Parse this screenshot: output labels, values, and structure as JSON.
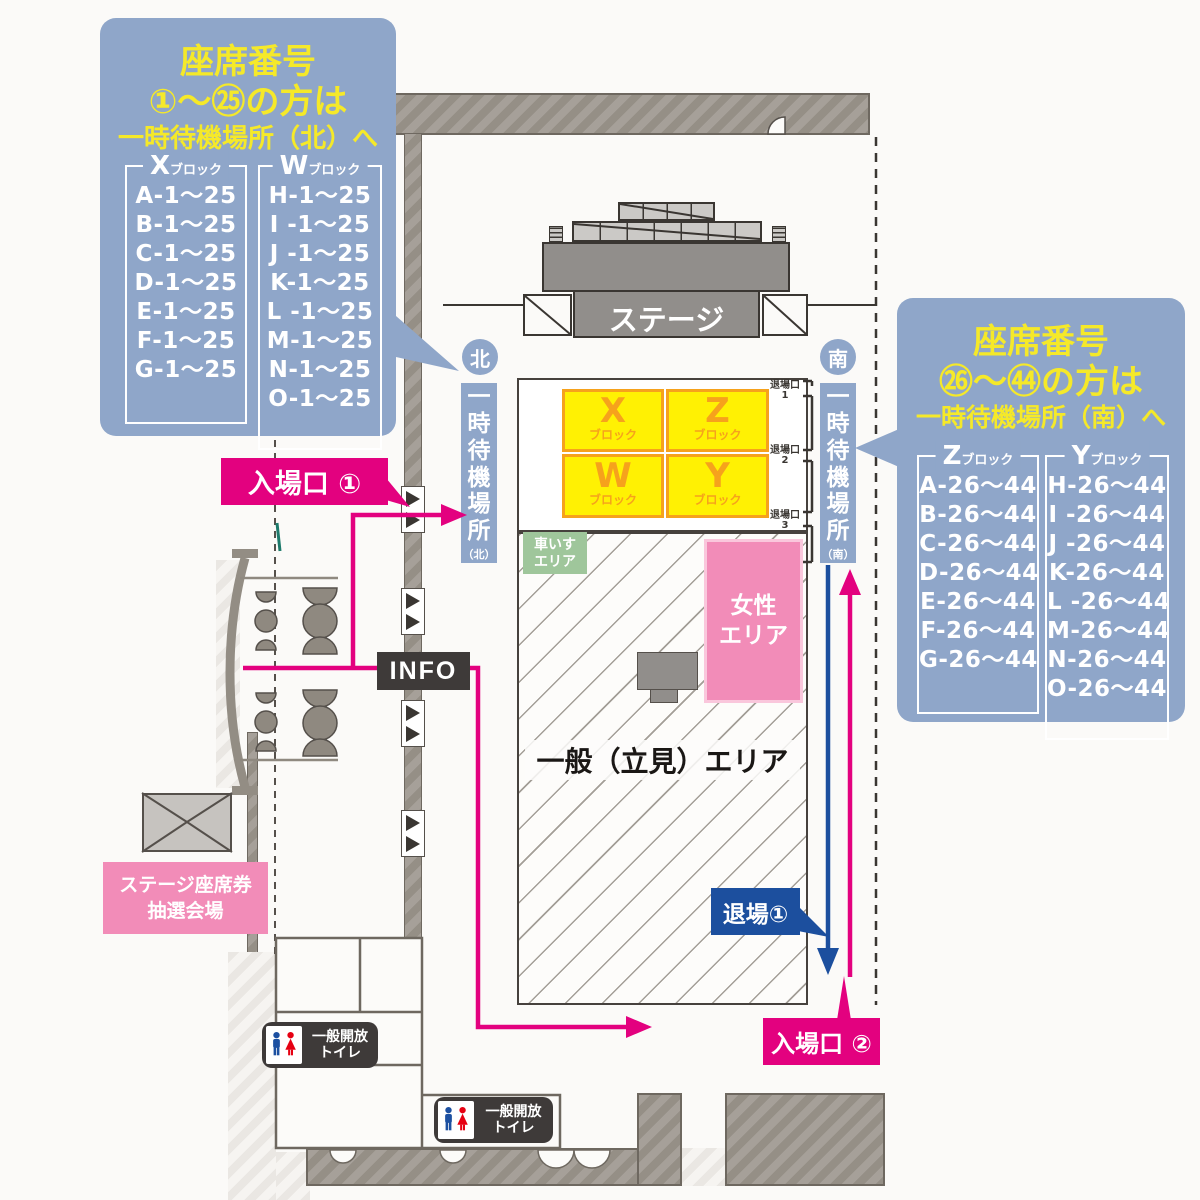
{
  "colors": {
    "panel_blue": "#8FA6C9",
    "title_yellow": "#F5E929",
    "block_yellow": "#FFF103",
    "block_orange": "#F6A21C",
    "route_pink": "#E3017F",
    "route_blue": "#1C4F9E",
    "women_pink": "#F28CB8",
    "wheelchair_green": "#9FC69B",
    "dark_gray": "#3E3A39"
  },
  "panels": {
    "north": {
      "title_line1": "座席番号",
      "title_line2": "①〜㉕の方は",
      "title_line3": "一時待機場所（北）へ",
      "columns": [
        {
          "letter": "X",
          "suffix": "ブロック",
          "rows": [
            "A-1〜25",
            "B-1〜25",
            "C-1〜25",
            "D-1〜25",
            "E-1〜25",
            "F-1〜25",
            "G-1〜25"
          ]
        },
        {
          "letter": "W",
          "suffix": "ブロック",
          "rows": [
            "H-1〜25",
            "I -1〜25",
            "J -1〜25",
            "K-1〜25",
            "L -1〜25",
            "M-1〜25",
            "N-1〜25",
            "O-1〜25"
          ]
        }
      ]
    },
    "south": {
      "title_line1": "座席番号",
      "title_line2": "㉖〜㊹の方は",
      "title_line3": "一時待機場所（南）へ",
      "columns": [
        {
          "letter": "Z",
          "suffix": "ブロック",
          "rows": [
            "A-26〜44",
            "B-26〜44",
            "C-26〜44",
            "D-26〜44",
            "E-26〜44",
            "F-26〜44",
            "G-26〜44"
          ]
        },
        {
          "letter": "Y",
          "suffix": "ブロック",
          "rows": [
            "H-26〜44",
            "I -26〜44",
            "J -26〜44",
            "K-26〜44",
            "L -26〜44",
            "M-26〜44",
            "N-26〜44",
            "O-26〜44"
          ]
        }
      ]
    }
  },
  "map": {
    "stage": "ステージ",
    "north_badge": "北",
    "south_badge": "南",
    "north_wait_bar": {
      "main": "一時待機場所",
      "sub": "（北）"
    },
    "south_wait_bar": {
      "main": "一時待機場所",
      "sub": "（南）"
    },
    "seat_blocks": [
      {
        "letter": "X",
        "suffix": "ブロック"
      },
      {
        "letter": "Z",
        "suffix": "ブロック"
      },
      {
        "letter": "W",
        "suffix": "ブロック"
      },
      {
        "letter": "Y",
        "suffix": "ブロック"
      }
    ],
    "exit_gates": [
      {
        "label": "退場口",
        "num": "1"
      },
      {
        "label": "退場口",
        "num": "2"
      },
      {
        "label": "退場口",
        "num": "3"
      }
    ],
    "wheelchair_area": {
      "line1": "車いす",
      "line2": "エリア"
    },
    "women_area": {
      "line1": "女性",
      "line2": "エリア"
    },
    "standing_area": "一般（立見）エリア",
    "entrance1": "入場口 ①",
    "entrance2": "入場口 ②",
    "exit1": "退場①",
    "info": "INFO",
    "lottery": {
      "line1": "ステージ座席券",
      "line2": "抽選会場"
    },
    "toilet": {
      "line1": "一般開放",
      "line2": "トイレ"
    }
  }
}
